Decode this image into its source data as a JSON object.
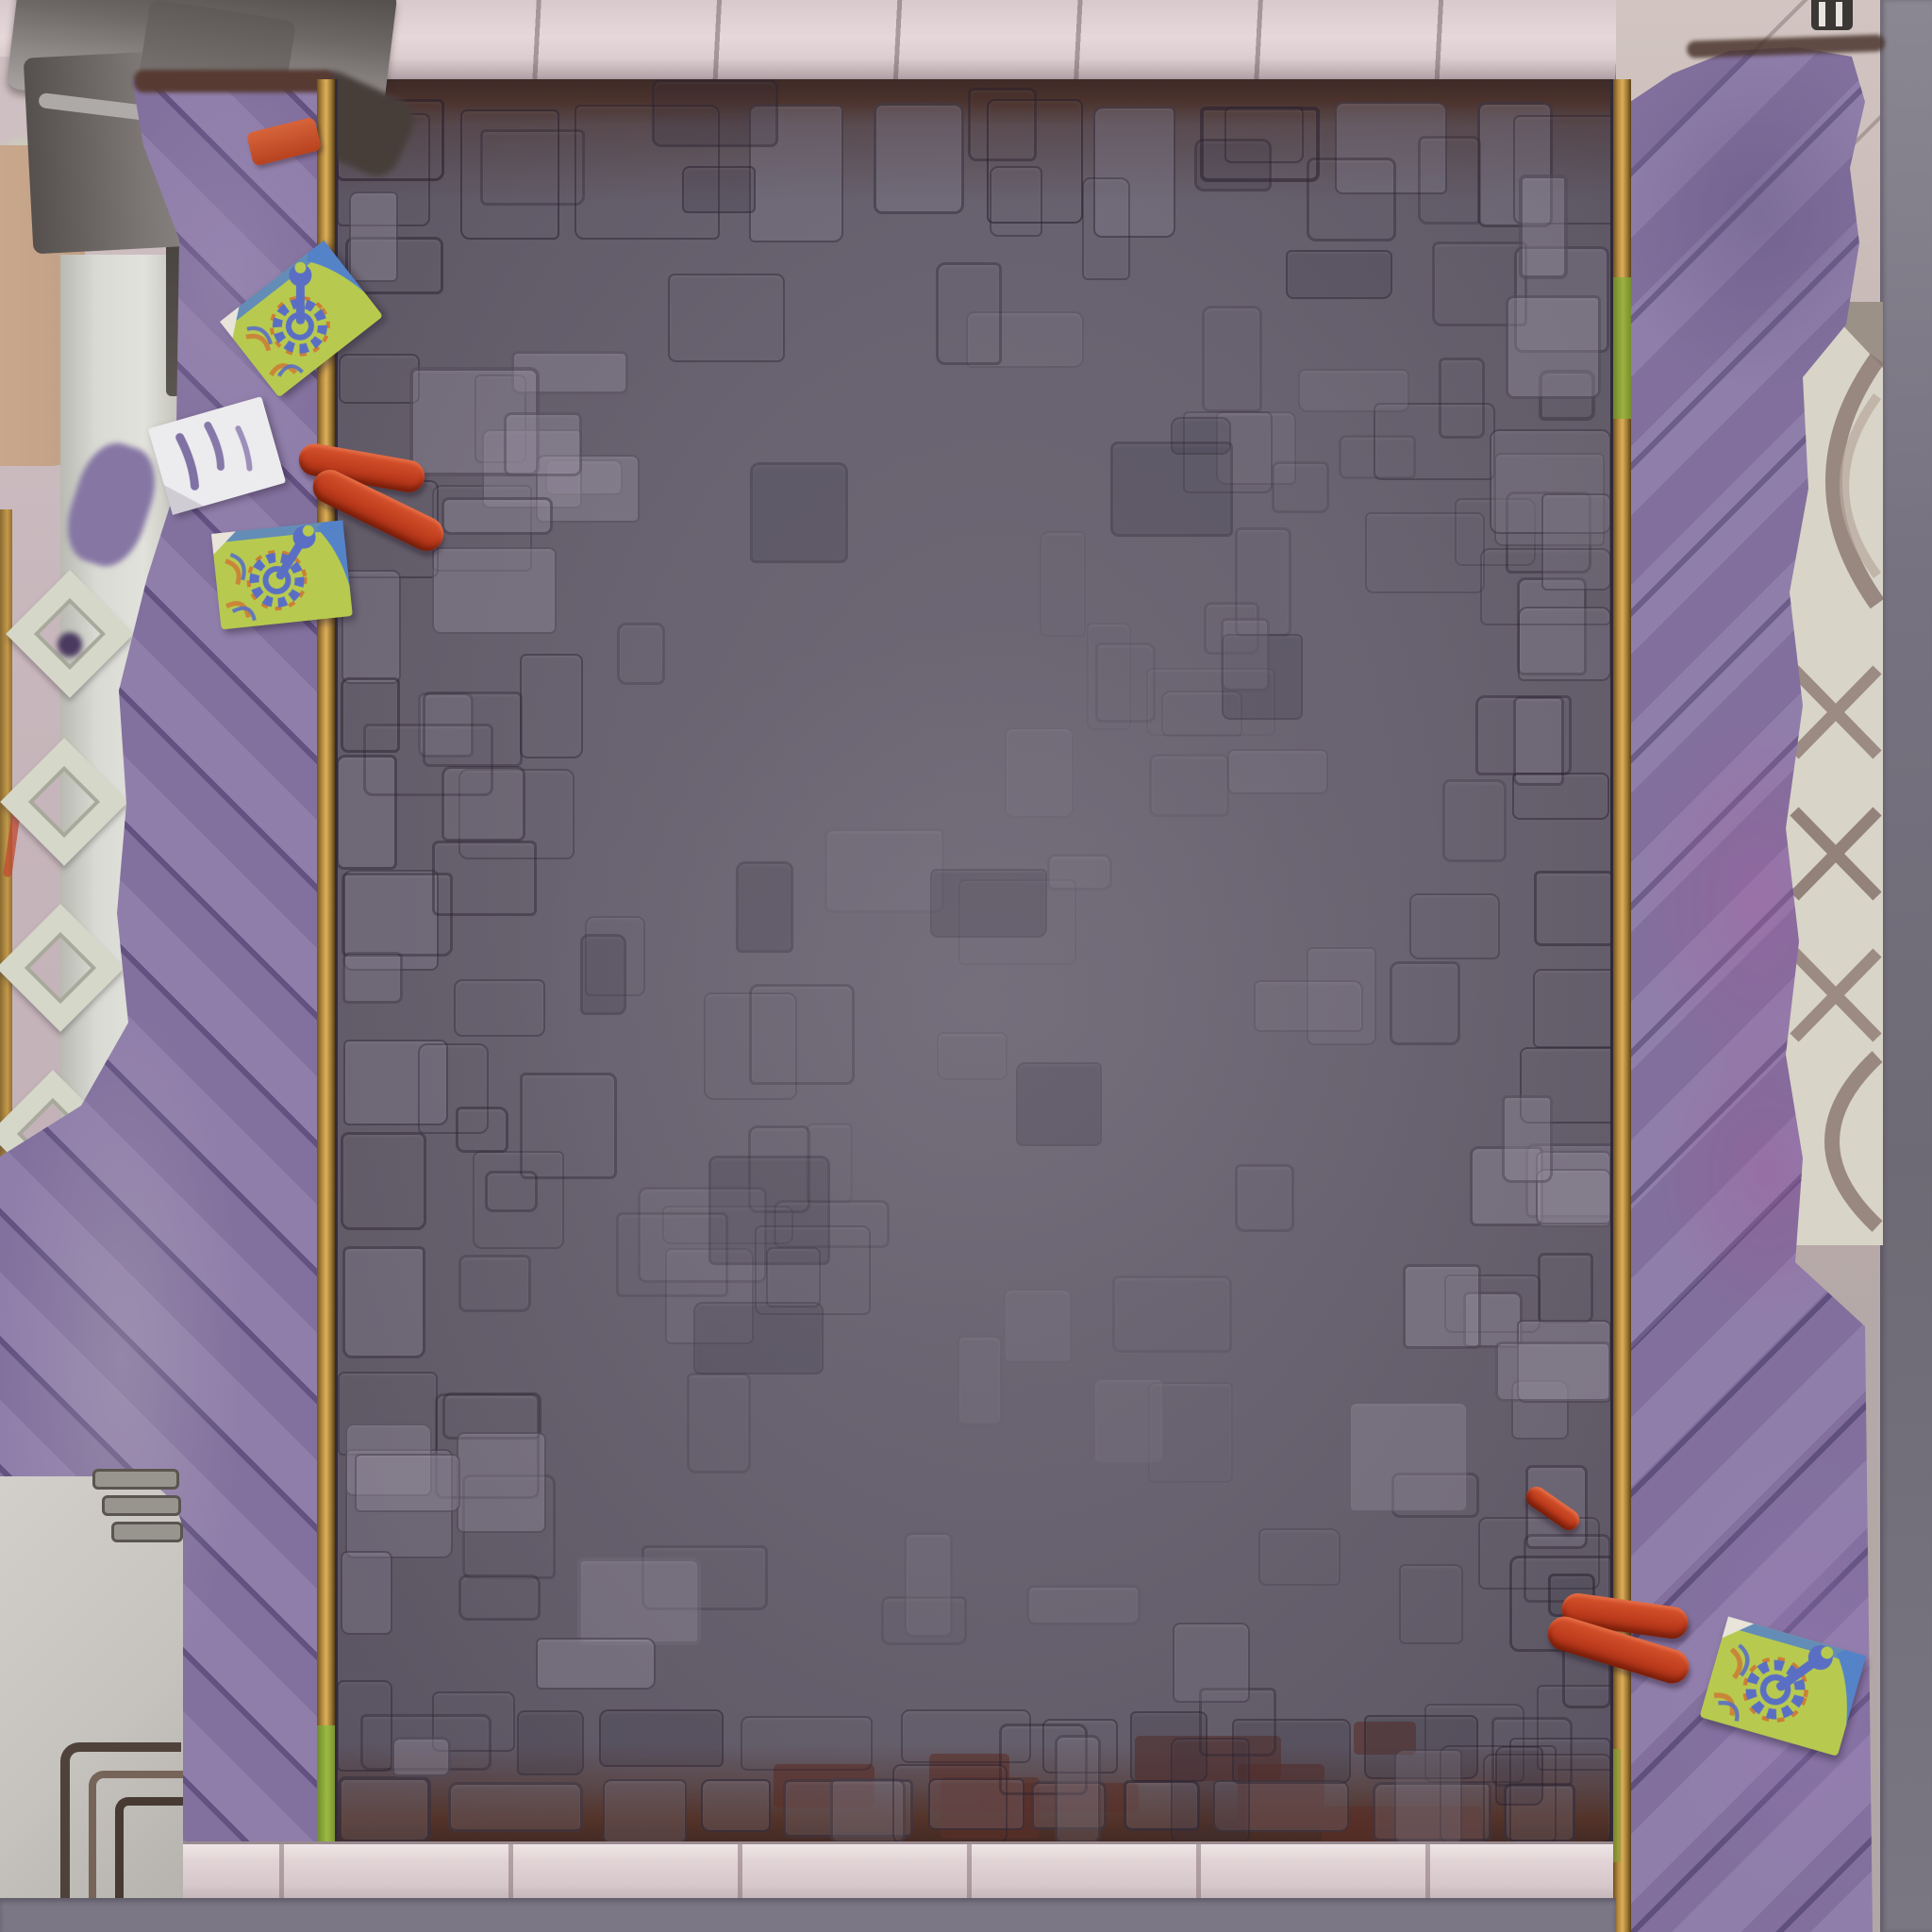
{
  "scene": {
    "type": "top-down-game-arena-floor",
    "regions": {
      "center": "cobblestone-floor",
      "left": "purple-plank-platform",
      "right": "purple-plank-platform",
      "top": "light-tile-border",
      "bottom": "light-tile-border-with-gray-footer",
      "left-outer": "white-wall-diamond-lattice-and-pillar",
      "right-outer": "white-lattice-and-gray-strip"
    }
  },
  "palette": {
    "floor": "#696371",
    "floor_edge_brown": "#46302a",
    "stone_line": "#2e2635",
    "purple_plank": "#8a77a6",
    "purple_seam": "#584a78",
    "purple_magenta_patch": "#a05f9e",
    "gold_trim": "#c5963f",
    "trim_green": "#8fae3a",
    "top_tiles": "#e0d2d5",
    "bottom_tiles": "#d9cccf",
    "footer_gray": "#7b7785",
    "right_gray_strip": "#716d78",
    "outer_wall_pink": "#c6b5ba",
    "lattice_cream": "#d8d4c7",
    "lattice_shadow": "#8d7a72",
    "pillar_gray": "#716c6a",
    "tan_block": "#c5a68c",
    "wall_white": "#cdcac5",
    "card_lime": "#b7ca4f",
    "card_blue_band": "#5583c8",
    "emblem_blue": "#5a6fc4",
    "emblem_orange": "#cc7e35",
    "item_red": "#c23f23",
    "paper_white": "#ecebee",
    "paper_mark_purple": "#6d5c98"
  },
  "decorations": [
    {
      "name": "red-brick",
      "area": "top-left-platform"
    },
    {
      "name": "wrench-gear-card",
      "area": "top-left-platform-upper"
    },
    {
      "name": "white-paper-note",
      "area": "top-left-platform"
    },
    {
      "name": "wrench-gear-card",
      "area": "top-left-platform-lower"
    },
    {
      "name": "red-sausage",
      "area": "top-left-over-trim"
    },
    {
      "name": "red-sausage",
      "area": "top-left-over-trim"
    },
    {
      "name": "red-sausage",
      "area": "bottom-right-small"
    },
    {
      "name": "red-sausage",
      "area": "bottom-right-over-trim"
    },
    {
      "name": "red-sausage",
      "area": "bottom-right-over-trim"
    },
    {
      "name": "wrench-gear-card",
      "area": "bottom-right-platform"
    }
  ]
}
